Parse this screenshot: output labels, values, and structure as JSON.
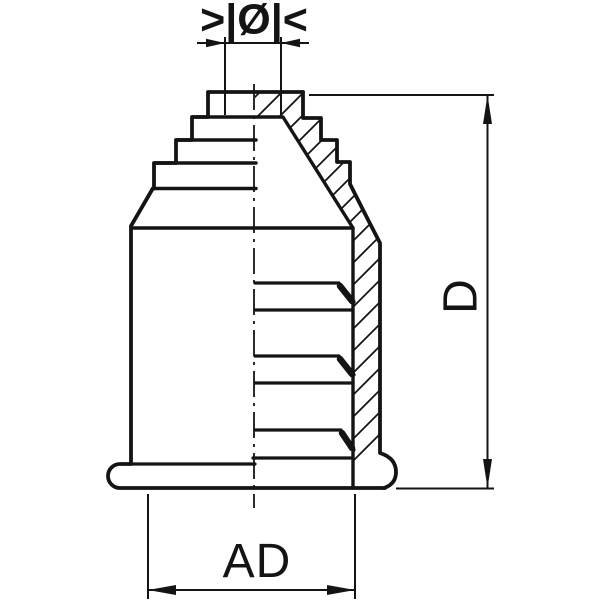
{
  "drawing": {
    "labels": {
      "top_diameter": ">|Ø|<",
      "side_height": "D",
      "bottom_width": "AD"
    },
    "colors": {
      "line": "#141414",
      "background": "#ffffff"
    }
  }
}
